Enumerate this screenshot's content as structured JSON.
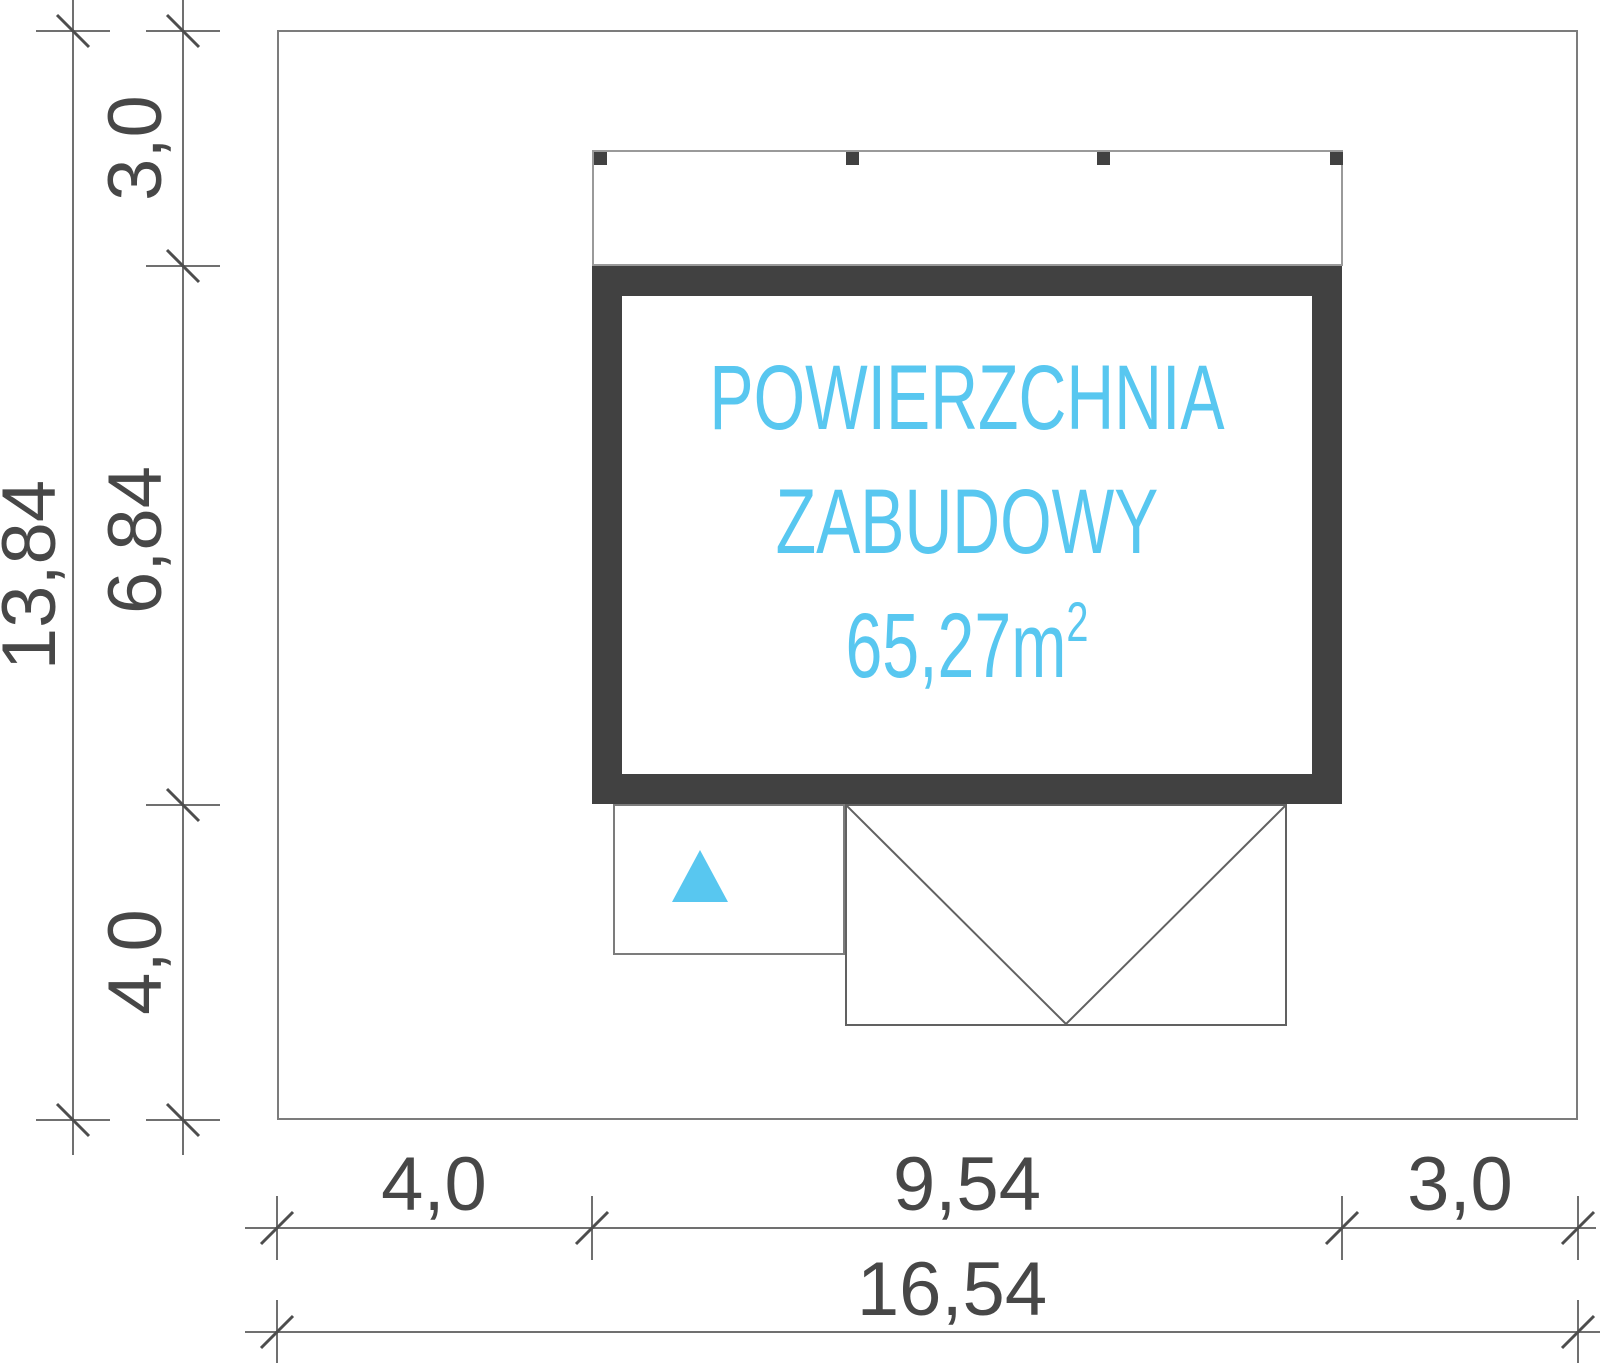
{
  "drawing": {
    "type": "site-plan",
    "area_label": {
      "line1": "POWIERZCHNIA",
      "line2": "ZABUDOWY",
      "value": "65,27m",
      "sup": "2"
    },
    "dimensions": {
      "left_overall": "13,84",
      "left_top": "3,0",
      "left_middle": "6,84",
      "left_bottom": "4,0",
      "bottom_left": "4,0",
      "bottom_middle": "9,54",
      "bottom_right": "3,0",
      "bottom_overall": "16,54"
    }
  },
  "colors": {
    "accent": "#58C7F0",
    "wall": "#414141",
    "dim_text": "#474747",
    "line": "#707070"
  }
}
